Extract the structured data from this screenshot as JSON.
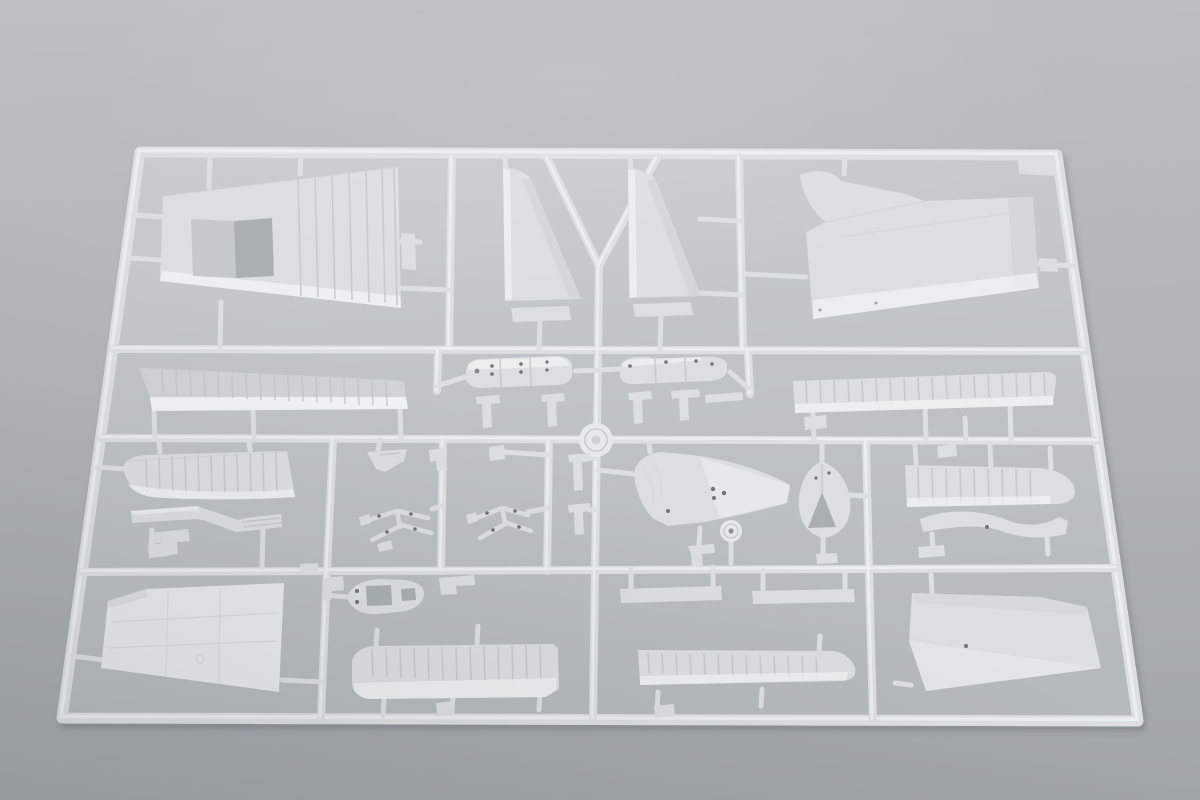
{
  "scene": {
    "subject": "plastic-model-kit-sprue",
    "setting": "gray studio surface, soft top light",
    "sprue": {
      "material": "light gray polystyrene",
      "frame": "rounded rectangle runner frame, slightly tilted in perspective",
      "horizontal_runners": 3,
      "identification_tab": "small blank tab inside top-right corner"
    },
    "parts": [
      {
        "name": "wing-panel-top-left",
        "kind": "upper wing half with rectangular cutout, side tab and rib detail"
      },
      {
        "name": "tail-fin-left",
        "kind": "vertical stabilizer half with separate base flap"
      },
      {
        "name": "tail-fin-right",
        "kind": "vertical stabilizer half with separate base flap"
      },
      {
        "name": "fuselage-panel-top-right",
        "kind": "large fuselage side panel with curved hook strip and side tab"
      },
      {
        "name": "corner-tab",
        "kind": "blank sprue tab"
      },
      {
        "name": "wing-strip-mid-left",
        "kind": "long ribbed wing strip"
      },
      {
        "name": "float-half-left",
        "kind": "float/torpedo half with rivet holes"
      },
      {
        "name": "float-half-right",
        "kind": "float/torpedo half with rivet holes"
      },
      {
        "name": "center-disc",
        "kind": "round grooved boss at runner crossing"
      },
      {
        "name": "wing-strip-mid-right",
        "kind": "long ribbed wing strip"
      },
      {
        "name": "hull-section-left",
        "kind": "curved ribbed hull/cowling piece"
      },
      {
        "name": "folded-step-strip",
        "kind": "Z-folded pleated strip"
      },
      {
        "name": "corner-dart",
        "kind": "small angled bracket"
      },
      {
        "name": "strut-cluster-left",
        "kind": "linked small struts"
      },
      {
        "name": "strut-cluster-right",
        "kind": "linked small struts"
      },
      {
        "name": "engine-deck",
        "kind": "cowl deck piece with access holes"
      },
      {
        "name": "wheel",
        "kind": "small wheel with hub"
      },
      {
        "name": "teardrop-fairing",
        "kind": "egg-shaped fairing with triangular opening"
      },
      {
        "name": "wing-strip-right",
        "kind": "ribbed strip with rounded tip"
      },
      {
        "name": "curved-spar",
        "kind": "wavy spar strip"
      },
      {
        "name": "wing-panel-bottom-left",
        "kind": "large bright wing half with panel lines"
      },
      {
        "name": "float-deck",
        "kind": "oval deck piece with rectangular openings"
      },
      {
        "name": "hatch-strip-left",
        "kind": "ribbed hatch strip with rounded end"
      },
      {
        "name": "hatch-strip-right",
        "kind": "ribbed hatch strip with rounded tip"
      },
      {
        "name": "fuselage-panel-bottom-right",
        "kind": "quadrilateral fuselage panel"
      },
      {
        "name": "small-fittings",
        "kind": "assorted tees, bars, brackets and feet along runners"
      }
    ]
  },
  "colors": {
    "background_top": "#bdc0c2",
    "background_bottom": "#a1a6aa",
    "inside_top": "#c9cdd0",
    "inside_bottom": "#b5babd",
    "runner": "#dddfe1",
    "runner_highlight": "#eff1f2",
    "plastic_bright": "#f1f2f3",
    "plastic_light": "#e7e9ea",
    "plastic": "#dcdfe1",
    "plastic_mid": "#d1d4d6",
    "plastic_shade": "#c5c9cb",
    "rib_line": "#c2c6c8",
    "hole": "#a9afb3",
    "dot": "#6e747a"
  }
}
